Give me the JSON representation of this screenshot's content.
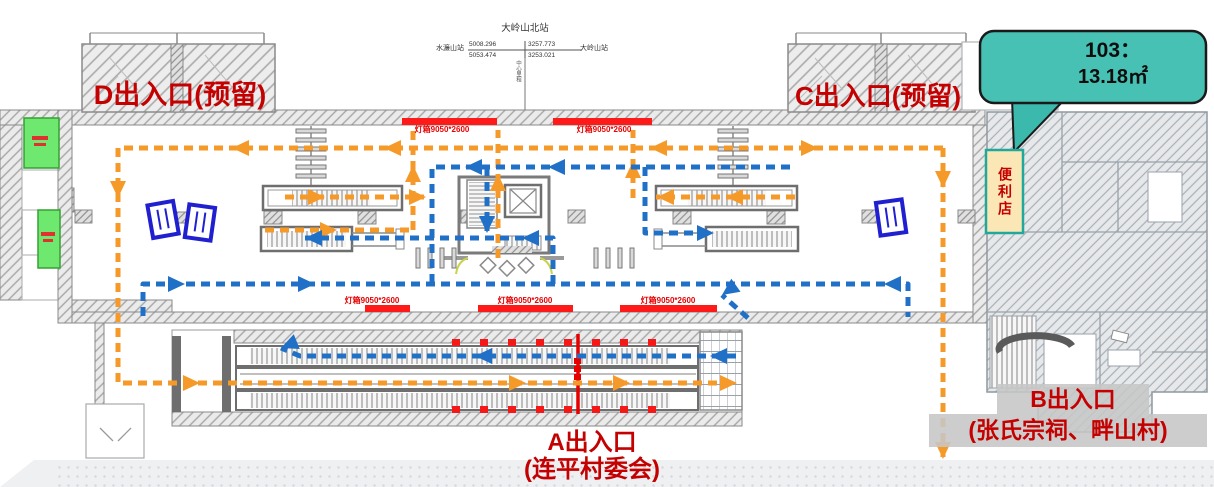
{
  "labels": {
    "entrance_d": "D出入口(预留)",
    "entrance_c": "C出入口(预留)",
    "entrance_a_line1": "A出入口",
    "entrance_a_line2": "(连平村委会)",
    "entrance_b_line1": "B出入口",
    "entrance_b_line2": "(张氏宗祠、畔山村)"
  },
  "callout": {
    "room_no": "103：",
    "area": "13.18㎡"
  },
  "store": {
    "name": "便利店"
  },
  "station_diagram": {
    "station_name": "大岭山北站",
    "prev_station": "水濂山站",
    "next_station": "大岭山站",
    "chainage_top_left": "5008.296",
    "chainage_top_right": "3257.773",
    "chainage_bottom_left": "5053.474",
    "chainage_bottom_right": "3253.021",
    "center_note": "中心里程"
  },
  "ads": {
    "label": "灯箱9050*2600"
  },
  "colors": {
    "flow_out_orange": "#F59A28",
    "flow_in_blue": "#2070C8",
    "highlight_red": "#C40000",
    "ad_red": "#FF1A1A",
    "callout_teal": "#46C1B4",
    "store_yellow": "#FBE7B5",
    "room_green": "#6FE86F"
  }
}
